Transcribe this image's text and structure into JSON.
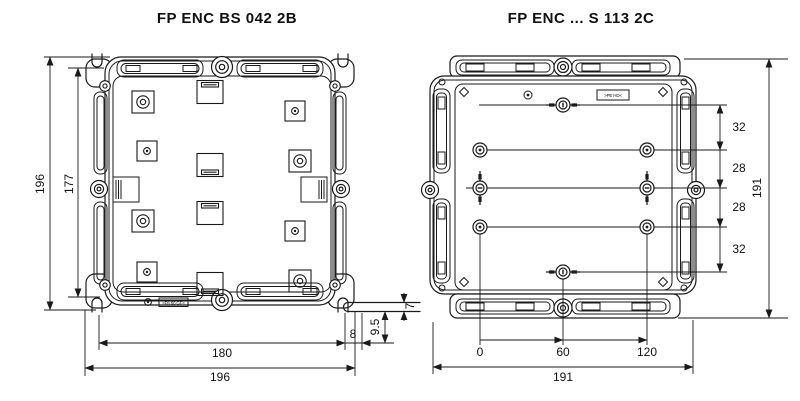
{
  "page": {
    "background": "#ffffff",
    "line_color": "#1a1a1a"
  },
  "left_drawing": {
    "title": "FP ENC BS 042 2B",
    "outer_height_label": "196",
    "inner_height_label": "177",
    "inner_width_label": "180",
    "outer_width_label": "196",
    "flange_width_label": "8",
    "flange_height_label": "9.5",
    "flange_thickness_label": "7",
    "material_mark": ">PA 66 GF<"
  },
  "right_drawing": {
    "title": "FP ENC ... S 113 2C",
    "hole_spacing_labels": [
      "32",
      "28",
      "28",
      "32"
    ],
    "outer_height_label": "191",
    "hole_x_labels": [
      "0",
      "60",
      "120"
    ],
    "outer_width_label": "191",
    "material_mark": ">PE HD<"
  }
}
